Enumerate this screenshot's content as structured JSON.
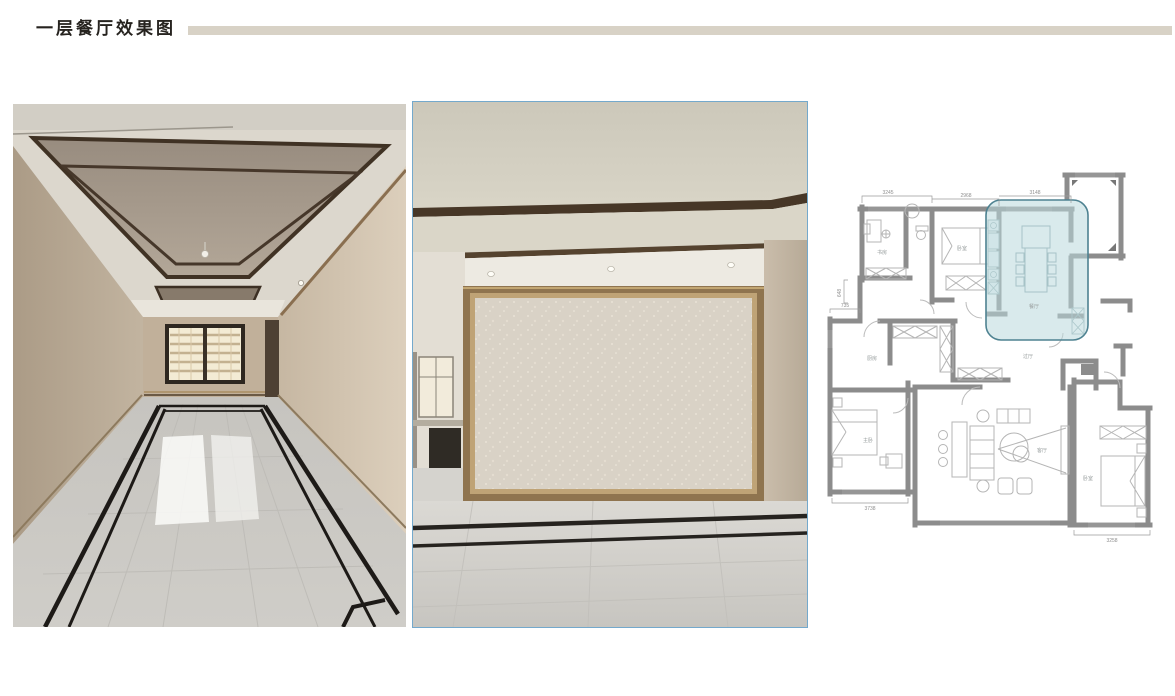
{
  "page": {
    "title": "一层餐厅效果图",
    "accent_bar_color": "#d8d2c6",
    "background_color": "#ffffff"
  },
  "photos": {
    "left": {
      "name": "dining-room-ceiling-and-marble-floor-photo"
    },
    "right": {
      "name": "dining-room-feature-wall-photo",
      "border_color": "#74a9cc"
    }
  },
  "floor_plan": {
    "highlighted_room": "餐厅",
    "highlight_fill": "#b9d8dc",
    "highlight_stroke": "#4e8291",
    "wall_color": "#8c8c8c",
    "dimensions": {
      "top": [
        "3245",
        "2968",
        "3148"
      ],
      "left_upper": "648",
      "left_lower": "735",
      "bottom_left": "3738",
      "bottom_right": "3258"
    },
    "rooms": [
      {
        "label": "书房"
      },
      {
        "label": "卧室"
      },
      {
        "label": "餐厅"
      },
      {
        "label": "过厅"
      },
      {
        "label": "厨房"
      },
      {
        "label": "主卧"
      },
      {
        "label": "客厅"
      },
      {
        "label": "卧室"
      }
    ]
  }
}
